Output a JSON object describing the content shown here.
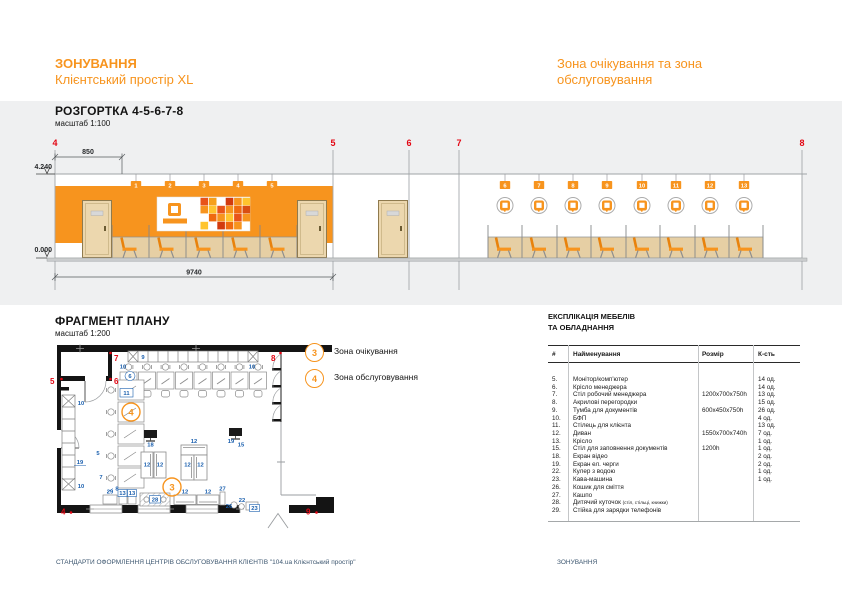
{
  "colors": {
    "accent": "#F7941E",
    "grid_red": "#E30613",
    "label_blue": "#1A5FAE",
    "footer_navy": "#3D5770",
    "band_grey": "#EFF0F1"
  },
  "header": {
    "project_line1": "ЗОНУВАННЯ",
    "project_line2": "Клієнтський простір XL",
    "sheet_title": "Зона очікування та зона обслуговування"
  },
  "elevation": {
    "title": "РОЗГОРТКА 4-5-6-7-8",
    "scale": "масштаб 1:100",
    "grid_labels": [
      "4",
      "5",
      "6",
      "7",
      "8"
    ],
    "level_top": "4.240",
    "level_bottom": "0.000",
    "dim_top": "850",
    "dim_overall": "9740",
    "seat_tags": [
      "1",
      "2",
      "3",
      "4",
      "5",
      "6",
      "7",
      "8",
      "9",
      "10",
      "11",
      "12",
      "13"
    ]
  },
  "plan": {
    "title": "ФРАГМЕНТ ПЛАНУ",
    "scale": "масштаб 1:200",
    "grid_labels": {
      "g4": "4",
      "g5": "5",
      "g6": "6",
      "g7": "7",
      "g8": "8",
      "g9": "9"
    },
    "zones": {
      "waiting": "3",
      "service": "4"
    },
    "labels": {
      "shelf": "9",
      "bfp_left": "10",
      "bfp_right": "10",
      "manager_chair": "6",
      "client_chair": "11",
      "cabinet_top": "10",
      "wall_screen": "19",
      "cabinet_bottom": "10",
      "desk_5": "5",
      "desk_7": "7",
      "partition_8": "8",
      "video_screen_18": "18",
      "queue_screen_19": "19",
      "fill_table_15": "15",
      "sofa_1": "12",
      "sofa_2": "12",
      "sofa_3": "12",
      "sofa_4": "12",
      "sofa_5": "12",
      "charge_29": "29",
      "chair_13a": "13",
      "chair_13b": "13",
      "kids_28": "28",
      "sofa_6": "12",
      "sofa_7": "12",
      "planter_27": "27",
      "trash_26": "26",
      "cooler_22": "22",
      "coffee_23": "23"
    }
  },
  "legend": {
    "items": [
      {
        "num": "3",
        "label": "Зона очікування"
      },
      {
        "num": "4",
        "label": "Зона обслуговування"
      }
    ]
  },
  "explication": {
    "title_line1": "ЕКСПЛІКАЦІЯ МЕБЕЛІВ",
    "title_line2": "ТА ОБЛАДНАННЯ",
    "col_num": "#",
    "col_name": "Найменування",
    "col_size": "Розмір",
    "col_qty": "К-сть",
    "rows": [
      {
        "num": "5.",
        "name": "Монітор/комп'ютер",
        "size": "",
        "qty": "14 од."
      },
      {
        "num": "6.",
        "name": "Крісло менеджера",
        "size": "",
        "qty": "14 од."
      },
      {
        "num": "7.",
        "name": "Стіл робочий менеджера",
        "size": "1200х700х750h",
        "qty": "13 од."
      },
      {
        "num": "8.",
        "name": "Акрилові перегородки",
        "size": "",
        "qty": "15 од."
      },
      {
        "num": "9.",
        "name": "Тумба для документів",
        "size": "600х450х750h",
        "qty": "26 од."
      },
      {
        "num": "10.",
        "name": "БФП",
        "size": "",
        "qty": "4 од."
      },
      {
        "num": "11.",
        "name": "Стілець для клієнта",
        "size": "",
        "qty": "13 од."
      },
      {
        "num": "12.",
        "name": "Диван",
        "size": "1550х700х740h",
        "qty": "7 од."
      },
      {
        "num": "13.",
        "name": "Крісло",
        "size": "",
        "qty": "1 од."
      },
      {
        "num": "15.",
        "name": "Стіл для заповнення документів",
        "size": "1200h",
        "qty": "1 од."
      },
      {
        "num": "18.",
        "name": "Екран відео",
        "size": "",
        "qty": "2 од."
      },
      {
        "num": "19.",
        "name": "Екран ел. черги",
        "size": "",
        "qty": "2 од."
      },
      {
        "num": "22.",
        "name": "Кулер з водою",
        "size": "",
        "qty": "1 од."
      },
      {
        "num": "23.",
        "name": "Кава-машина",
        "size": "",
        "qty": "1 од."
      },
      {
        "num": "26.",
        "name": "Кошик для сміття",
        "size": "",
        "qty": ""
      },
      {
        "num": "27.",
        "name": "Кашпо",
        "size": "",
        "qty": ""
      },
      {
        "num": "28.",
        "name": "Дитячий куточок",
        "note": "(стіл, стільці, книжки)",
        "size": "",
        "qty": ""
      },
      {
        "num": "29.",
        "name": "Стійка для зарядки телефонів",
        "size": "",
        "qty": ""
      }
    ]
  },
  "footer": {
    "left": "СТАНДАРТИ ОФОРМЛЕННЯ ЦЕНТРІВ ОБСЛУГОВУВАННЯ КЛІЄНТІВ \"104.ua Клієнтський простір\"",
    "right": "ЗОНУВАННЯ"
  }
}
